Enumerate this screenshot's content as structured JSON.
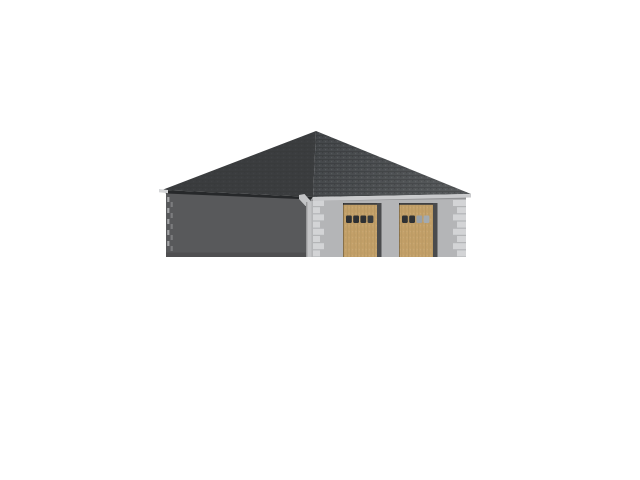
{
  "scene": {
    "name": "garage-3d-render",
    "background": "#ffffff",
    "colors": {
      "roof_left": "#3b3d3f",
      "roof_right_top": "#434649",
      "roof_right_bottom": "#575a5c",
      "soffit_shadow": "#26282a",
      "fascia": "#c9cacc",
      "fascia_tip": "#d5d6d8",
      "side_wall": "#58595b",
      "front_wall": "#b4b5b7",
      "quoin": "#d3d4d6",
      "downspout": "#c3c4c6",
      "door_panel": "#c4a169",
      "door_side_strip": "#4a4b4d",
      "door_header": "#3f4042"
    },
    "doors": [
      {
        "x": 343,
        "window_colors": [
          "#2e3032",
          "#2e3032",
          "#2e3032",
          "#383b3d"
        ]
      },
      {
        "x": 399,
        "window_colors": [
          "#2f3133",
          "#2f3133",
          "#99a0a7",
          "#a3aab0"
        ]
      }
    ],
    "door_layout": {
      "y": 203,
      "w": 34,
      "h": 54,
      "strip_w": 4.5,
      "win_y": 215.5,
      "win_w": 5.8,
      "win_h": 7.5,
      "win_offsets": [
        3,
        10.2,
        17.4,
        24.6
      ]
    },
    "quoin_columns": [
      {
        "x_edge": 313,
        "align": "left",
        "widths": [
          11,
          7
        ]
      },
      {
        "x_edge": 466,
        "align": "right",
        "widths": [
          13,
          9
        ]
      }
    ],
    "quoin_layout": {
      "rows": 8,
      "row_step": 7.2,
      "y_top": 200,
      "block_h": 6
    },
    "shadow_quoin_dashes": {
      "cols": [
        {
          "x": 167.2,
          "color": "#a3a4a6",
          "y0": 197
        },
        {
          "x": 170.6,
          "color": "#7b7c7e",
          "y0": 202
        }
      ],
      "w": 2.2,
      "h": 5,
      "step": 11,
      "y_max": 255
    }
  }
}
